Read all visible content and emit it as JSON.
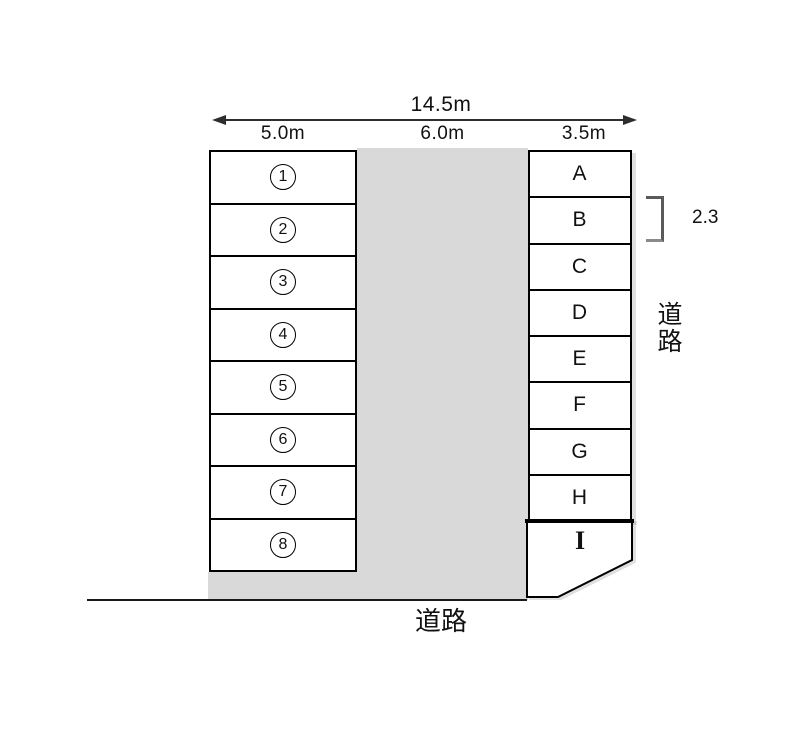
{
  "diagram": {
    "dimensions": {
      "total_width": "14.5m",
      "left_column_width": "5.0m",
      "driveway_width": "6.0m",
      "right_column_width": "3.5m",
      "stall_depth": "2.3"
    },
    "left_spaces": [
      "1",
      "2",
      "3",
      "4",
      "5",
      "6",
      "7",
      "8"
    ],
    "right_spaces": [
      "A",
      "B",
      "C",
      "D",
      "E",
      "F",
      "G",
      "H"
    ],
    "corner_space": "I",
    "road_label_right": "道路",
    "road_label_bottom": "道路",
    "colors": {
      "driveway_gray": "#d9d9d9",
      "line_black": "#000000",
      "background": "#ffffff"
    }
  }
}
